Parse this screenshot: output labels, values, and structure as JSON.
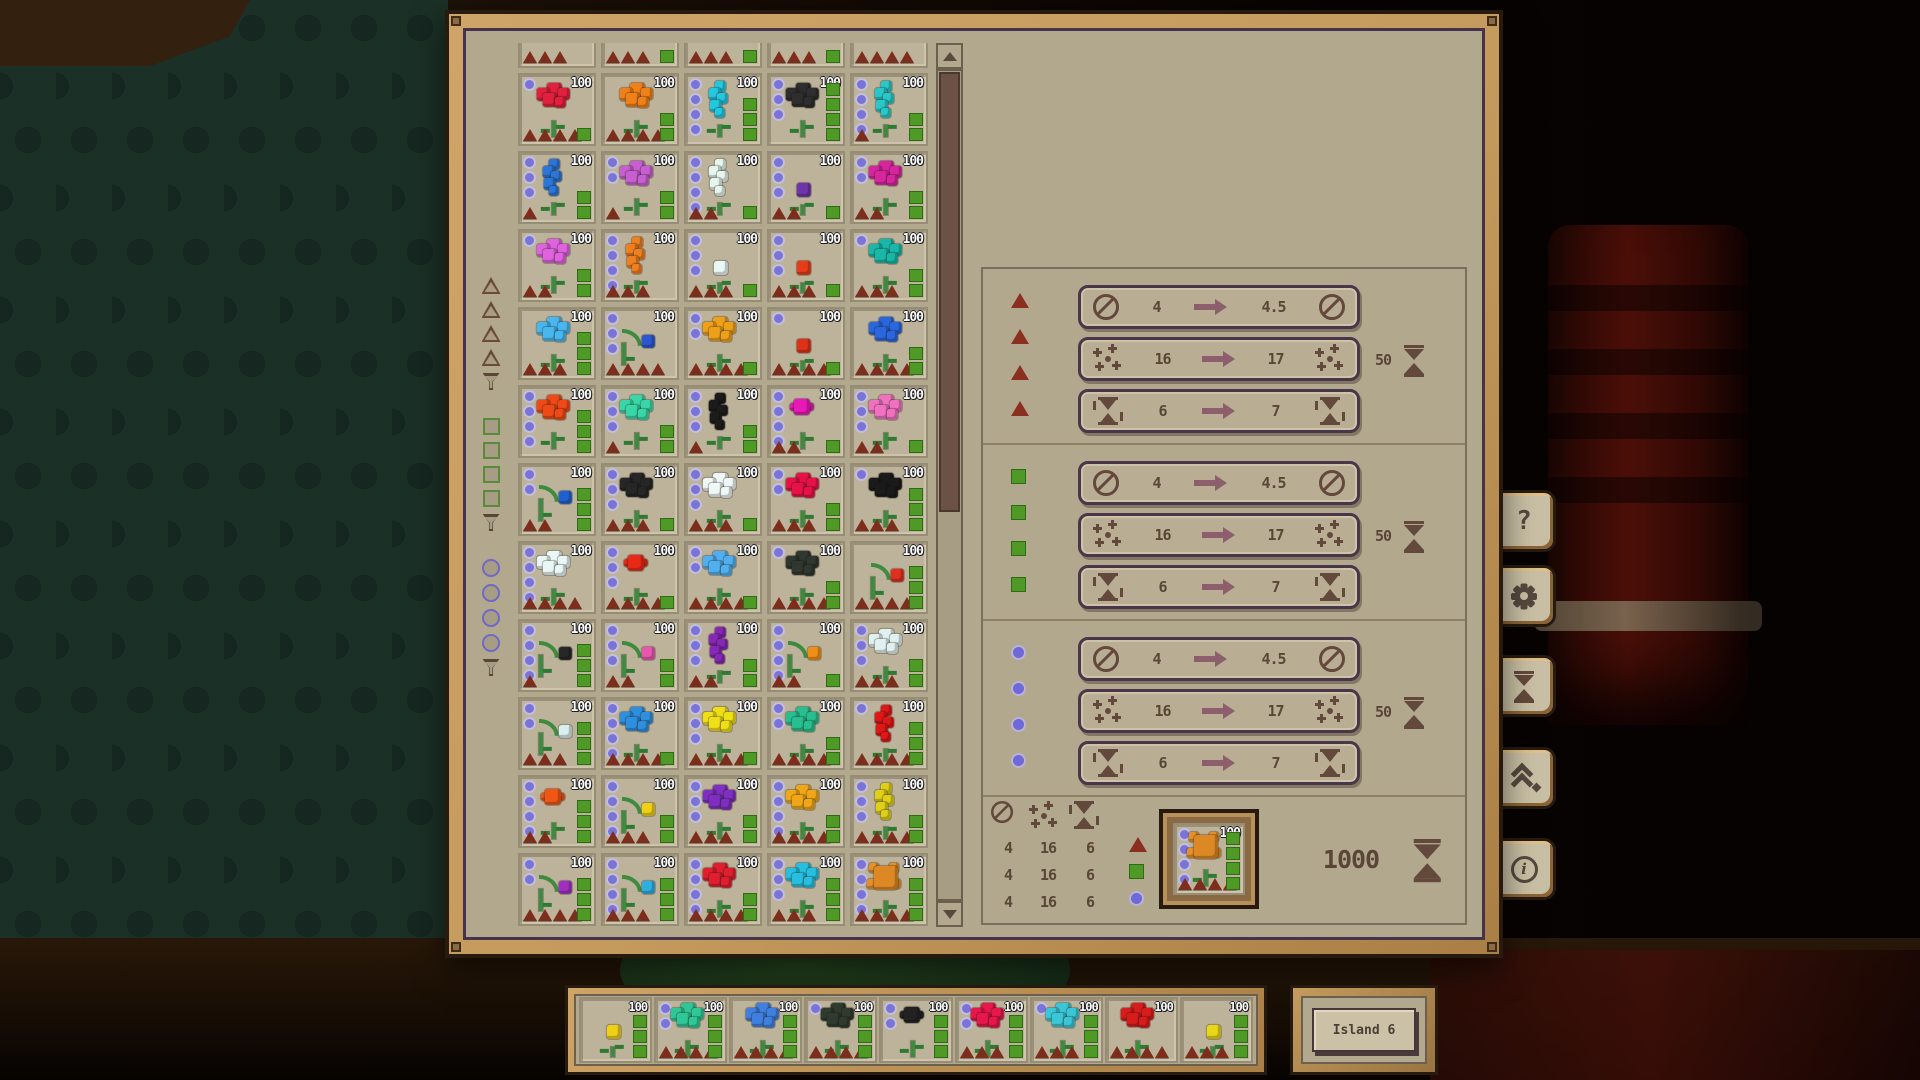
{
  "colors": {
    "panel_bg": "#b2a88e",
    "frame_wood": "#c49a5d",
    "card_bg": "#bdb39a",
    "circle": "#7b74d8",
    "triangle": "#7d2d1c",
    "square": "#4f9a26",
    "icon_brown": "#63493b",
    "value_text": "#5a4636",
    "arrow": "#8d5f6d"
  },
  "filters": {
    "groups": [
      {
        "shape": "triangle",
        "levels": 4
      },
      {
        "shape": "square",
        "levels": 4
      },
      {
        "shape": "circle",
        "levels": 4
      }
    ]
  },
  "grid": {
    "partial_top_row": [
      {
        "color": "",
        "shape": "none",
        "count": "100",
        "circles": 0,
        "triangles": 3,
        "squares": 0
      },
      {
        "color": "",
        "shape": "none",
        "count": "100",
        "circles": 0,
        "triangles": 3,
        "squares": 1
      },
      {
        "color": "",
        "shape": "none",
        "count": "100",
        "circles": 0,
        "triangles": 3,
        "squares": 1
      },
      {
        "color": "",
        "shape": "none",
        "count": "100",
        "circles": 0,
        "triangles": 3,
        "squares": 1
      },
      {
        "color": "",
        "shape": "none",
        "count": "100",
        "circles": 0,
        "triangles": 4,
        "squares": 0
      }
    ],
    "rows": [
      [
        {
          "color": "#e0203c",
          "shape": "cluster",
          "count": "100",
          "circles": 1,
          "triangles": 4,
          "squares": 1
        },
        {
          "color": "#f08018",
          "shape": "cluster",
          "count": "100",
          "circles": 0,
          "triangles": 4,
          "squares": 2
        },
        {
          "color": "#22c8e0",
          "shape": "tall",
          "count": "100",
          "circles": 4,
          "triangles": 0,
          "squares": 3
        },
        {
          "color": "#2e2e2e",
          "shape": "cluster",
          "count": "100",
          "circles": 3,
          "triangles": 0,
          "squares": 4
        },
        {
          "color": "#28c8c8",
          "shape": "tall",
          "count": "100",
          "circles": 4,
          "triangles": 1,
          "squares": 2
        }
      ],
      [
        {
          "color": "#2b76d8",
          "shape": "tall",
          "count": "100",
          "circles": 3,
          "triangles": 1,
          "squares": 2
        },
        {
          "color": "#c85fd0",
          "shape": "cluster",
          "count": "100",
          "circles": 2,
          "triangles": 1,
          "squares": 2
        },
        {
          "color": "#e6f6ee",
          "shape": "tall",
          "count": "100",
          "circles": 4,
          "triangles": 2,
          "squares": 1
        },
        {
          "color": "#6d35a8",
          "shape": "small",
          "count": "100",
          "circles": 3,
          "triangles": 2,
          "squares": 1
        },
        {
          "color": "#d8259e",
          "shape": "cluster",
          "count": "100",
          "circles": 2,
          "triangles": 2,
          "squares": 2
        }
      ],
      [
        {
          "color": "#df63df",
          "shape": "cluster",
          "count": "100",
          "circles": 1,
          "triangles": 2,
          "squares": 2
        },
        {
          "color": "#ef7f1f",
          "shape": "tall",
          "count": "100",
          "circles": 4,
          "triangles": 3,
          "squares": 0
        },
        {
          "color": "#e9f7f7",
          "shape": "small",
          "count": "100",
          "circles": 3,
          "triangles": 3,
          "squares": 1
        },
        {
          "color": "#e73c17",
          "shape": "small",
          "count": "100",
          "circles": 3,
          "triangles": 3,
          "squares": 1
        },
        {
          "color": "#19b7a7",
          "shape": "cluster",
          "count": "100",
          "circles": 1,
          "triangles": 3,
          "squares": 2
        }
      ],
      [
        {
          "color": "#49b7ef",
          "shape": "cluster",
          "count": "100",
          "circles": 0,
          "triangles": 3,
          "squares": 3
        },
        {
          "color": "#2a57cf",
          "shape": "droop",
          "count": "100",
          "circles": 3,
          "triangles": 4,
          "squares": 0
        },
        {
          "color": "#efa019",
          "shape": "cluster",
          "count": "100",
          "circles": 2,
          "triangles": 4,
          "squares": 1
        },
        {
          "color": "#df3117",
          "shape": "small",
          "count": "100",
          "circles": 1,
          "triangles": 4,
          "squares": 1
        },
        {
          "color": "#2a67df",
          "shape": "cluster",
          "count": "100",
          "circles": 0,
          "triangles": 4,
          "squares": 2
        }
      ],
      [
        {
          "color": "#ef4917",
          "shape": "cluster",
          "count": "100",
          "circles": 4,
          "triangles": 0,
          "squares": 3
        },
        {
          "color": "#39d7a7",
          "shape": "cluster",
          "count": "100",
          "circles": 3,
          "triangles": 1,
          "squares": 2
        },
        {
          "color": "#1b1b1b",
          "shape": "tall",
          "count": "100",
          "circles": 3,
          "triangles": 1,
          "squares": 2
        },
        {
          "color": "#e719b7",
          "shape": "tulip",
          "count": "100",
          "circles": 4,
          "triangles": 2,
          "squares": 1
        },
        {
          "color": "#ef71bf",
          "shape": "cluster",
          "count": "100",
          "circles": 3,
          "triangles": 2,
          "squares": 1
        }
      ],
      [
        {
          "color": "#2161cf",
          "shape": "droop",
          "count": "100",
          "circles": 2,
          "triangles": 2,
          "squares": 3
        },
        {
          "color": "#262626",
          "shape": "cluster",
          "count": "100",
          "circles": 3,
          "triangles": 3,
          "squares": 1
        },
        {
          "color": "#eff7f7",
          "shape": "cluster",
          "count": "100",
          "circles": 3,
          "triangles": 3,
          "squares": 1
        },
        {
          "color": "#e71147",
          "shape": "cluster",
          "count": "100",
          "circles": 2,
          "triangles": 3,
          "squares": 2
        },
        {
          "color": "#1a1a1a",
          "shape": "cluster",
          "count": "100",
          "circles": 1,
          "triangles": 3,
          "squares": 3
        }
      ],
      [
        {
          "color": "#e9f7f7",
          "shape": "cluster",
          "count": "100",
          "circles": 4,
          "triangles": 4,
          "squares": 0
        },
        {
          "color": "#e72917",
          "shape": "tulip",
          "count": "100",
          "circles": 3,
          "triangles": 4,
          "squares": 1
        },
        {
          "color": "#51afef",
          "shape": "cluster",
          "count": "100",
          "circles": 2,
          "triangles": 4,
          "squares": 1
        },
        {
          "color": "#2f372f",
          "shape": "cluster",
          "count": "100",
          "circles": 1,
          "triangles": 4,
          "squares": 2
        },
        {
          "color": "#df2f1f",
          "shape": "droop",
          "count": "100",
          "circles": 0,
          "triangles": 4,
          "squares": 3
        }
      ],
      [
        {
          "color": "#272727",
          "shape": "droop",
          "count": "100",
          "circles": 4,
          "triangles": 1,
          "squares": 3
        },
        {
          "color": "#e757af",
          "shape": "droop",
          "count": "100",
          "circles": 3,
          "triangles": 2,
          "squares": 2
        },
        {
          "color": "#8727b7",
          "shape": "tall",
          "count": "100",
          "circles": 3,
          "triangles": 2,
          "squares": 2
        },
        {
          "color": "#ef8f17",
          "shape": "droop",
          "count": "100",
          "circles": 4,
          "triangles": 2,
          "squares": 1
        },
        {
          "color": "#e1f1ef",
          "shape": "cluster",
          "count": "100",
          "circles": 3,
          "triangles": 3,
          "squares": 2
        }
      ],
      [
        {
          "color": "#d9efef",
          "shape": "droop",
          "count": "100",
          "circles": 2,
          "triangles": 3,
          "squares": 3
        },
        {
          "color": "#2f8fdf",
          "shape": "cluster",
          "count": "100",
          "circles": 4,
          "triangles": 4,
          "squares": 1
        },
        {
          "color": "#efdf17",
          "shape": "cluster",
          "count": "100",
          "circles": 3,
          "triangles": 4,
          "squares": 1
        },
        {
          "color": "#27bf8f",
          "shape": "cluster",
          "count": "100",
          "circles": 2,
          "triangles": 4,
          "squares": 2
        },
        {
          "color": "#df1717",
          "shape": "tall",
          "count": "100",
          "circles": 1,
          "triangles": 4,
          "squares": 3
        }
      ],
      [
        {
          "color": "#ef5717",
          "shape": "tulip",
          "count": "100",
          "circles": 4,
          "triangles": 2,
          "squares": 3
        },
        {
          "color": "#efcf17",
          "shape": "droop",
          "count": "100",
          "circles": 4,
          "triangles": 3,
          "squares": 2
        },
        {
          "color": "#7f2fbf",
          "shape": "cluster",
          "count": "100",
          "circles": 3,
          "triangles": 3,
          "squares": 2
        },
        {
          "color": "#efa717",
          "shape": "cluster",
          "count": "100",
          "circles": 4,
          "triangles": 4,
          "squares": 2
        },
        {
          "color": "#dfcf17",
          "shape": "tall",
          "count": "100",
          "circles": 3,
          "triangles": 4,
          "squares": 2
        }
      ],
      [
        {
          "color": "#9f2fbf",
          "shape": "droop",
          "count": "100",
          "circles": 2,
          "triangles": 4,
          "squares": 3
        },
        {
          "color": "#2fafdf",
          "shape": "droop",
          "count": "100",
          "circles": 4,
          "triangles": 3,
          "squares": 3
        },
        {
          "color": "#df1f2f",
          "shape": "cluster",
          "count": "100",
          "circles": 4,
          "triangles": 4,
          "squares": 2
        },
        {
          "color": "#27bfdf",
          "shape": "cluster",
          "count": "100",
          "circles": 3,
          "triangles": 3,
          "squares": 3
        },
        {
          "color": "#e79027",
          "shape": "sunflower",
          "count": "100",
          "circles": 4,
          "triangles": 4,
          "squares": 3
        }
      ]
    ]
  },
  "upgrades": {
    "groups": [
      {
        "marker": "triangle",
        "rows": [
          {
            "icon": "diameter",
            "from": "4",
            "to": "4.5"
          },
          {
            "icon": "sparkles",
            "from": "16",
            "to": "17",
            "cost": "50",
            "cost_icon": "hourglass"
          },
          {
            "icon": "cycle",
            "from": "6",
            "to": "7"
          }
        ]
      },
      {
        "marker": "square",
        "rows": [
          {
            "icon": "diameter",
            "from": "4",
            "to": "4.5"
          },
          {
            "icon": "sparkles",
            "from": "16",
            "to": "17",
            "cost": "50",
            "cost_icon": "hourglass"
          },
          {
            "icon": "cycle",
            "from": "6",
            "to": "7"
          }
        ]
      },
      {
        "marker": "circle",
        "rows": [
          {
            "icon": "diameter",
            "from": "4",
            "to": "4.5"
          },
          {
            "icon": "sparkles",
            "from": "16",
            "to": "17",
            "cost": "50",
            "cost_icon": "hourglass"
          },
          {
            "icon": "cycle",
            "from": "6",
            "to": "7"
          }
        ]
      }
    ],
    "summary": {
      "columns": [
        "diameter",
        "sparkles",
        "cycle"
      ],
      "rows": [
        {
          "marker": "triangle",
          "values": [
            "4",
            "16",
            "6"
          ]
        },
        {
          "marker": "square",
          "values": [
            "4",
            "16",
            "6"
          ]
        },
        {
          "marker": "circle",
          "values": [
            "4",
            "16",
            "6"
          ]
        }
      ],
      "selected_card": {
        "color": "#e79027",
        "shape": "sunflower",
        "count": "100",
        "circles": 4,
        "triangles": 4,
        "squares": 4
      },
      "total_cost": "1000",
      "total_cost_icon": "hourglass"
    }
  },
  "side_buttons": [
    {
      "id": "help",
      "icon": "question",
      "glyph": "?"
    },
    {
      "id": "settings",
      "icon": "gear"
    },
    {
      "id": "time",
      "icon": "hourglass"
    },
    {
      "id": "upgrades",
      "icon": "chevrons-up"
    },
    {
      "id": "info",
      "icon": "info",
      "glyph": "i"
    }
  ],
  "bottom_bar": {
    "cards": [
      {
        "color": "#efcf17",
        "shape": "small",
        "count": "100",
        "circles": 0,
        "triangles": 0,
        "squares": 3
      },
      {
        "color": "#2fc795",
        "shape": "cluster",
        "count": "100",
        "circles": 2,
        "triangles": 4,
        "squares": 3
      },
      {
        "color": "#3f7fdf",
        "shape": "cluster",
        "count": "100",
        "circles": 0,
        "triangles": 4,
        "squares": 3
      },
      {
        "color": "#2f3b2f",
        "shape": "cluster",
        "count": "100",
        "circles": 1,
        "triangles": 4,
        "squares": 3
      },
      {
        "color": "#222222",
        "shape": "tulip",
        "count": "100",
        "circles": 2,
        "triangles": 0,
        "squares": 3
      },
      {
        "color": "#e7174b",
        "shape": "cluster",
        "count": "100",
        "circles": 2,
        "triangles": 3,
        "squares": 3
      },
      {
        "color": "#39c7d7",
        "shape": "cluster",
        "count": "100",
        "circles": 1,
        "triangles": 3,
        "squares": 3
      },
      {
        "color": "#d71c1c",
        "shape": "cluster",
        "count": "100",
        "circles": 0,
        "triangles": 4,
        "squares": 0
      },
      {
        "color": "#e7d717",
        "shape": "small",
        "count": "100",
        "circles": 0,
        "triangles": 3,
        "squares": 3
      }
    ]
  },
  "island": {
    "label": "Island 6"
  }
}
